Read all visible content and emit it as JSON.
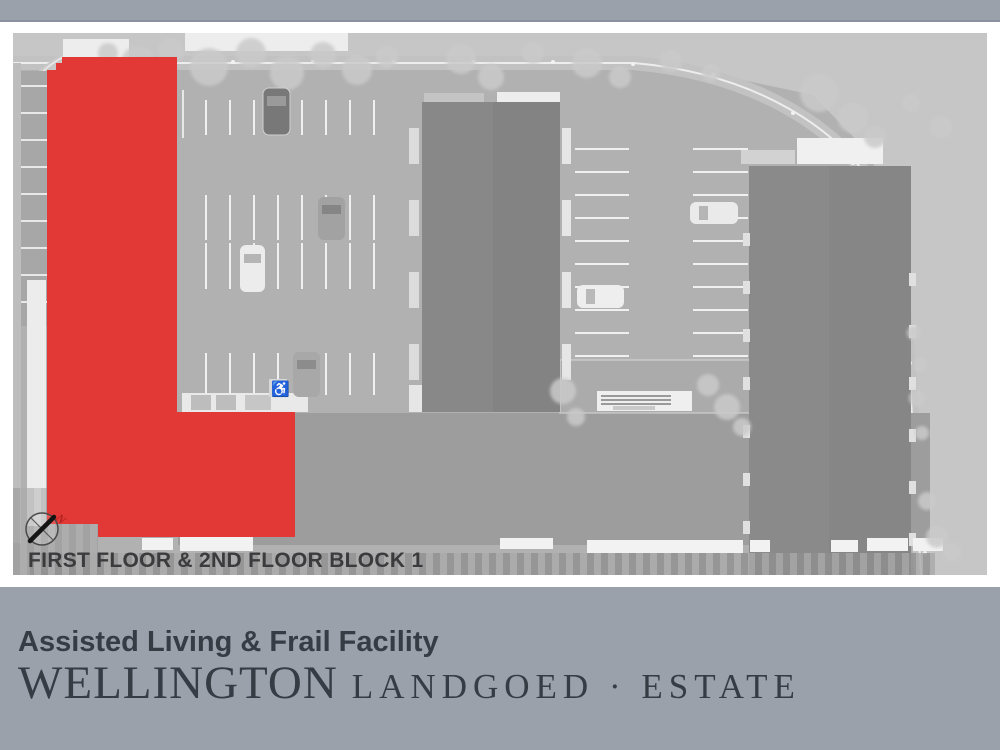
{
  "colors": {
    "band": "#9aa1ab",
    "highlight": "#e33936",
    "footer_text": "#363c44",
    "caption_text": "#3b3b3d",
    "compass_north": "#b22222"
  },
  "plan": {
    "caption": "FIRST FLOOR & 2ND FLOOR BLOCK 1",
    "compass_label": "N"
  },
  "icons": {
    "accessible_parking": "♿"
  },
  "footer": {
    "subtitle": "Assisted Living & Frail Facility",
    "brand_primary": "WELLINGTON",
    "brand_secondary": "LANDGOED · ESTATE"
  }
}
